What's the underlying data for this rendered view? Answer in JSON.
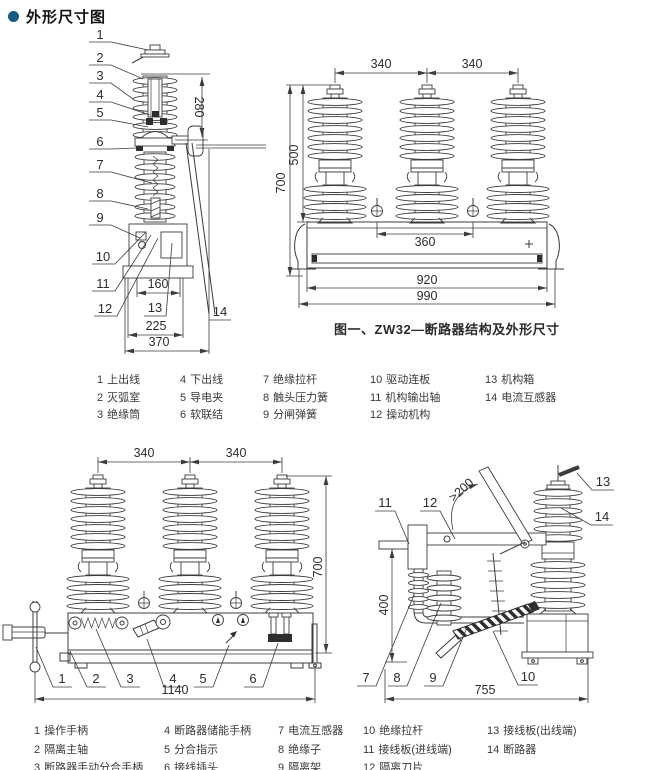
{
  "page": {
    "title": "外形尺寸图",
    "accent_color": "#155a82",
    "line_color": "#3c3c3c"
  },
  "figure1": {
    "caption": "图一、ZW32—断路器结构及外形尺寸",
    "side_view": {
      "callouts": [
        "1",
        "2",
        "3",
        "4",
        "5",
        "6",
        "7",
        "8",
        "9",
        "10",
        "11",
        "12",
        "13",
        "14"
      ],
      "dims": {
        "upper_height": "280",
        "hole_spacing": "160",
        "base_width": "225",
        "total_width": "370"
      }
    },
    "front_view": {
      "dims": {
        "pole_spacing_1": "340",
        "pole_spacing_2": "340",
        "insulator_height": "500",
        "total_height": "700",
        "hole_spacing": "360",
        "body_width": "920",
        "total_width": "990"
      }
    }
  },
  "legend1": {
    "items": [
      {
        "num": "1",
        "label": "上出线"
      },
      {
        "num": "2",
        "label": "灭弧室"
      },
      {
        "num": "3",
        "label": "绝缘筒"
      },
      {
        "num": "4",
        "label": "下出线"
      },
      {
        "num": "5",
        "label": "导电夹"
      },
      {
        "num": "6",
        "label": "软联结"
      },
      {
        "num": "7",
        "label": "绝缘拉杆"
      },
      {
        "num": "8",
        "label": "触头压力簧"
      },
      {
        "num": "9",
        "label": "分闸弹簧"
      },
      {
        "num": "10",
        "label": "驱动连板"
      },
      {
        "num": "11",
        "label": "机构输出轴"
      },
      {
        "num": "12",
        "label": "操动机构"
      },
      {
        "num": "13",
        "label": "机构箱"
      },
      {
        "num": "14",
        "label": "电流互感器"
      }
    ]
  },
  "figure2": {
    "front_view": {
      "callouts": [
        "1",
        "2",
        "3",
        "4",
        "5",
        "6"
      ],
      "dims": {
        "pole_spacing_1": "340",
        "pole_spacing_2": "340",
        "total_height": "700",
        "total_width": "1140"
      }
    },
    "side_view": {
      "callouts": [
        "7",
        "8",
        "9",
        "10",
        "11",
        "12",
        "13",
        "14"
      ],
      "dims": {
        "clearance": ">200",
        "frame_height": "400",
        "total_depth": "755"
      }
    }
  },
  "legend2": {
    "items": [
      {
        "num": "1",
        "label": "操作手柄"
      },
      {
        "num": "2",
        "label": "隔离主轴"
      },
      {
        "num": "3",
        "label": "断路器手动分合手柄"
      },
      {
        "num": "4",
        "label": "断路器储能手柄"
      },
      {
        "num": "5",
        "label": "分合指示"
      },
      {
        "num": "6",
        "label": "接线插头"
      },
      {
        "num": "7",
        "label": "电流互感器"
      },
      {
        "num": "8",
        "label": "绝缘子"
      },
      {
        "num": "9",
        "label": "隔离架"
      },
      {
        "num": "10",
        "label": "绝缘拉杆"
      },
      {
        "num": "11",
        "label": "接线板(进线端)"
      },
      {
        "num": "12",
        "label": "隔离刀片"
      },
      {
        "num": "13",
        "label": "接线板(出线端)"
      },
      {
        "num": "14",
        "label": "断路器"
      }
    ]
  }
}
